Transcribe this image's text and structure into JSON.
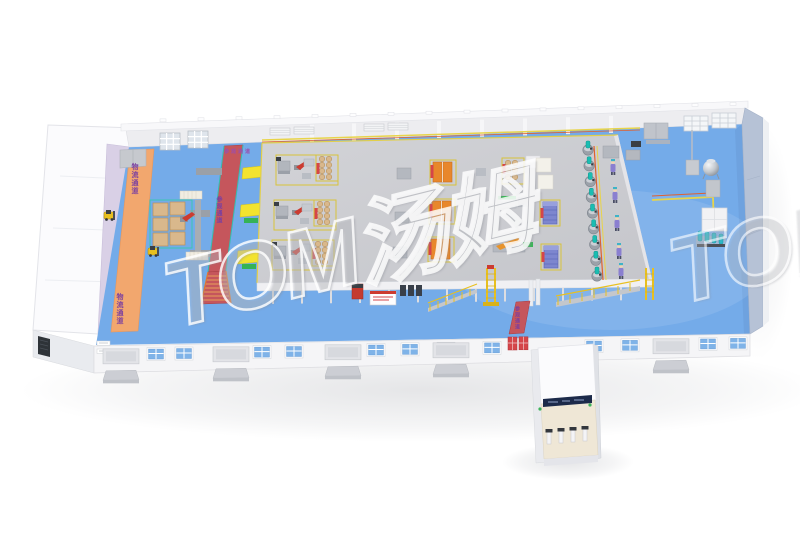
{
  "scene": {
    "description": "3D isometric rendering of a factory workshop layout",
    "background": "#ffffff"
  },
  "watermark": {
    "main": "TOM汤姆",
    "partial": "TOM"
  },
  "labels": {
    "logistics_aisle_top": "物流通道",
    "logistics_aisle_bottom": "物流通道",
    "visitor_walkway_header": "参观通道",
    "visitor_walkway_vertical": "参观通道",
    "exit_aisle": "参观通道"
  },
  "colors": {
    "floor_blue": "#74abe9",
    "aisle_orange": "#f2a76e",
    "walkway_red": "#c5565c",
    "platform_gray": "#cbccd0",
    "conveyor_yellow": "#f3e32f",
    "green_segment": "#35b356",
    "wall_white": "#f5f5f7",
    "right_wall_blue_gray": "#b6c2d6",
    "left_wall_lavender": "#d9d0e6",
    "window_blue": "#7fb3e8",
    "red_door": "#d5454a",
    "mixer_teal": "#1abdb2",
    "cabinet_orange": "#e8872b",
    "pallet_tan": "#d9b88c",
    "violet_stack": "#7d86cf",
    "robot_red": "#cc3b30",
    "forklift_yellow": "#e8c020",
    "worker_purple": "#8a7fd0",
    "label_purple": "#7a3fa0"
  }
}
